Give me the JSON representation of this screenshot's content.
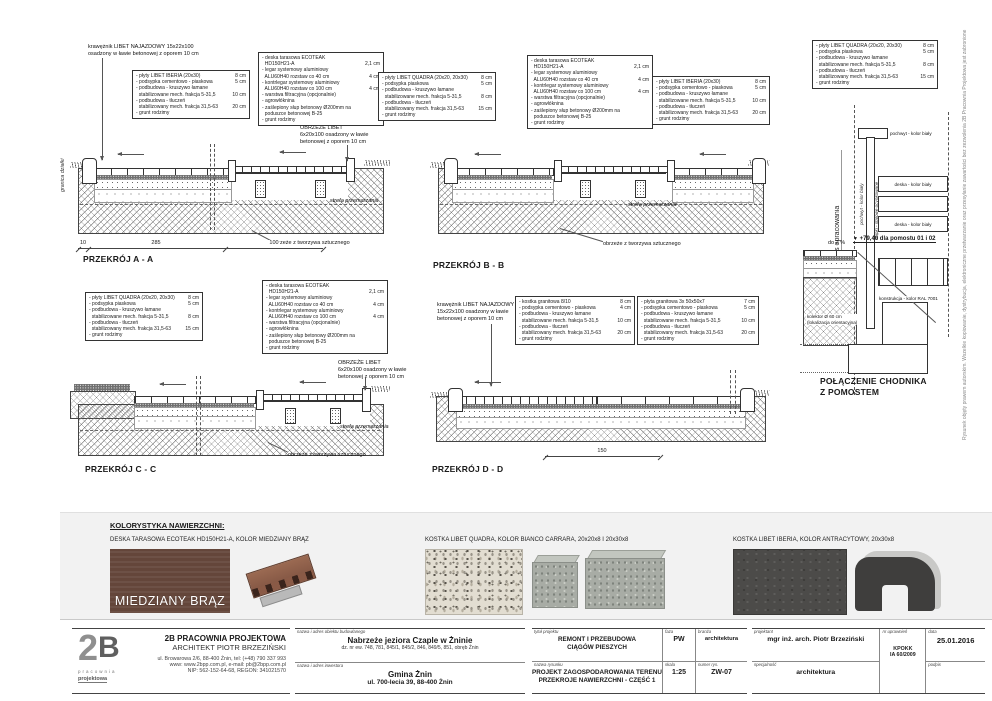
{
  "edge": {
    "granica": "granica działki",
    "copyright": "Rysunek objęty prawem autorskim. Wszelkie kopiowanie, dystrybucja, elektroniczne przetwarzanie oraz przesyłanie zawartości bez zezwolenia 2B Pracownia Projektowa jest zabronione"
  },
  "spec_boxes": {
    "iberia": {
      "lines": [
        {
          "t": "- płyty LIBET IBERIA (20x30)",
          "v": "8 cm"
        },
        {
          "t": "- podsypka cementowo - piaskowa",
          "v": "5 cm"
        },
        {
          "t": "- podbudowa - kruszywo łamane",
          "v": ""
        },
        {
          "t": "  stabilizowane mech. frakcja 5-31,5",
          "v": "10 cm"
        },
        {
          "t": "- podbudowa - tłuczeń",
          "v": ""
        },
        {
          "t": "  stabilizowany mech. frakcja 31,5-63",
          "v": "20 cm"
        },
        {
          "t": "- grunt rodzimy",
          "v": ""
        }
      ]
    },
    "quadra": {
      "lines": [
        {
          "t": "- płyty LIBET QUADRA (20x20, 20x30)",
          "v": "8 cm"
        },
        {
          "t": "- podsypka piaskowa",
          "v": "5 cm"
        },
        {
          "t": "- podbudowa - kruszywo łamane",
          "v": ""
        },
        {
          "t": "  stabilizowane mech. frakcja 5-31,5",
          "v": "8 cm"
        },
        {
          "t": "- podbudowa - tłuczeń",
          "v": ""
        },
        {
          "t": "  stabilizowany mech. frakcja 31,5-63",
          "v": "15 cm"
        },
        {
          "t": "- grunt rodzimy",
          "v": ""
        }
      ]
    },
    "ecoteak": {
      "lines": [
        {
          "t": "- deska tarasowa ECOTEAK",
          "v": ""
        },
        {
          "t": "  HD150H21-A",
          "v": "2,1 cm"
        },
        {
          "t": "- legar systemowy aluminiowy",
          "v": ""
        },
        {
          "t": "  ALU60H40 rozstaw co 40 cm",
          "v": "4 cm"
        },
        {
          "t": "- kontrlegar systemowy aluminiowy",
          "v": ""
        },
        {
          "t": "  ALU60H40 rozstaw co 100 cm",
          "v": "4 cm"
        },
        {
          "t": "- warstwa filtracyjna (opcjonalnie)",
          "v": ""
        },
        {
          "t": "- agrowłóknina",
          "v": ""
        },
        {
          "t": "- zaślepiony słup betonowy Ø200mm na",
          "v": ""
        },
        {
          "t": "  poduszce betonowej B-25",
          "v": ""
        },
        {
          "t": "- grunt rodzimy",
          "v": ""
        }
      ]
    },
    "kostka": {
      "lines": [
        {
          "t": "- kostka granitowa 8/10",
          "v": "8 cm"
        },
        {
          "t": "- podsypka cementowo - piaskowa",
          "v": "4 cm"
        },
        {
          "t": "- podbudowa - kruszywo łamane",
          "v": ""
        },
        {
          "t": "  stabilizowane mech. frakcja 5-31,5",
          "v": "10 cm"
        },
        {
          "t": "- podbudowa - tłuczeń",
          "v": ""
        },
        {
          "t": "  stabilizowany mech. frakcja 31,5-63",
          "v": "20 cm"
        },
        {
          "t": "- grunt rodzimy",
          "v": ""
        }
      ]
    },
    "plyta": {
      "lines": [
        {
          "t": "- płyta granitowa 3x 50x50x7",
          "v": "7 cm"
        },
        {
          "t": "- podsypka cementowo - piaskowa",
          "v": "5 cm"
        },
        {
          "t": "- podbudowa - kruszywo łamane",
          "v": ""
        },
        {
          "t": "  stabilizowane mech. frakcja 5-31,5",
          "v": "10 cm"
        },
        {
          "t": "- podbudowa - tłuczeń",
          "v": ""
        },
        {
          "t": "  stabilizowany mech. frakcja 31,5-63",
          "v": "20 cm"
        },
        {
          "t": "- grunt rodzimy",
          "v": ""
        }
      ]
    }
  },
  "sections": {
    "a": {
      "title": "PRZEKRÓJ A - A",
      "kraweznik": "krawężnik LIBET NAJAZDOWY 15x22x100\nosadzony w ławie betonowej z oporem 10 cm",
      "obrzeze_libet": "OBRZEŻE LIBET\n6x20x100 osadzony w ławie\nbetonowej z oporem 10 cm",
      "obrzeze_tw": "obrzeże z tworzywa sztucznego",
      "strefa": "strefa przemarzania",
      "dim10": "10",
      "dim285": "285",
      "dim100": "100"
    },
    "b": {
      "title": "PRZEKRÓJ B - B",
      "obrzeze_tw": "obrzeże z tworzywa sztucznego",
      "strefa": "strefa przemarzania"
    },
    "c": {
      "title": "PRZEKRÓJ C - C",
      "obrzeze_libet": "OBRZEŻE LIBET\n6x20x100 osadzony w ławie\nbetonowej z oporem 10 cm",
      "obrzeze_tw": "obrzeże z tworzywa sztucznego",
      "strefa": "strefa przemarzania"
    },
    "d": {
      "title": "PRZEKRÓJ D - D",
      "kraweznik": "krawężnik LIBET NAJAZDOWY\n15x22x100 osadzony w ławie\nbetonowej z oporem 10 cm",
      "dim150": "150"
    }
  },
  "pomost": {
    "title": "POŁĄCZENIE CHODNIKA\nZ POMOSTEM",
    "zakres": "zakres opracowania",
    "pochwyt": "pochwyt - kolor biały",
    "slupki": "słupki - stalowe ocynkowane",
    "deska": "deska - kolor biały",
    "elev_marker": "▼",
    "elev": "+79,40 dla pomostu 01 i 02",
    "slope": "do 2 %",
    "konstrukcja": "konstrukcja - kolor RAL 7001",
    "kolektor": "kolektor Ø 60 cm\n(lokalizacja orientacyjna)"
  },
  "kolorystyka": {
    "header": "KOLORYSTYKA NAWIERZCHNI:",
    "item1": "DESKA TARASOWA ECOTEAK HD150H21-A, KOLOR MIEDZIANY BRĄZ",
    "item2": "KOSTKA LIBET QUADRA, KOLOR BIANCO CARRARA, 20x20x8 I 20x30x8",
    "item3": "KOSTKA LIBET IBERIA, KOLOR ANTRACYTOWY, 20x30x8",
    "swatch_text": "MIEDZIANY BRĄZ",
    "brown_hex": "#64463a",
    "anthracite_hex": "#4c4b49"
  },
  "titleblock": {
    "company": {
      "logo1": "2",
      "logo2": "B",
      "logo_sub1": "pracownia",
      "logo_sub2": "projektowa",
      "name": "2B PRACOWNIA PROJEKTOWA",
      "architect": "ARCHITEKT PIOTR BRZEZIŃSKI",
      "line1": "ul. Browarowa 2/6, 88-400 Żnin, tel: (+48) 790 337 993",
      "line2": "www: www.2bpp.com.pl, e-mail: pb@2bpp.com.pl",
      "line3": "NIP: 562-152-64-68, REGON: 341021570"
    },
    "object": {
      "label": "nazwa i adres obiektu budowlanego",
      "name": "Nabrzeże jeziora Czaple w Żninie",
      "sub": "dz. nr ew. 748, 781, 845/1, 845/2, 846, 849/5, 851, obręb Żnin"
    },
    "investor": {
      "label": "nazwa i adres inwestora",
      "name": "Gmina Żnin",
      "sub": "ul. 700-lecia 39, 88-400 Żnin"
    },
    "project": {
      "label": "tytuł projektu",
      "value": "REMONT I PRZEBUDOWA\nCIĄGÓW PIESZYCH",
      "faza_label": "faza",
      "faza": "PW",
      "branza_label": "branża",
      "branza": "architektura"
    },
    "drawing": {
      "label": "nazwa rysunku",
      "value": "PROJEKT ZAGOSPODAROWANIA TERENU\nPRZEKROJE NAWIERZCHNI - CZĘŚĆ 1",
      "skala_label": "skala",
      "skala": "1:25",
      "numer_label": "numer rys.",
      "numer": "ZW-07"
    },
    "designer": {
      "label": "projektant",
      "value": "mgr inż. arch. Piotr Brzeziński",
      "upr_label": "nr uprawnień",
      "upr": "KPOKK\nIA 60/2009",
      "data_label": "data",
      "data": "25.01.2016",
      "spec_label": "specjalność",
      "spec": "architektura",
      "podpis_label": "podpis"
    }
  }
}
